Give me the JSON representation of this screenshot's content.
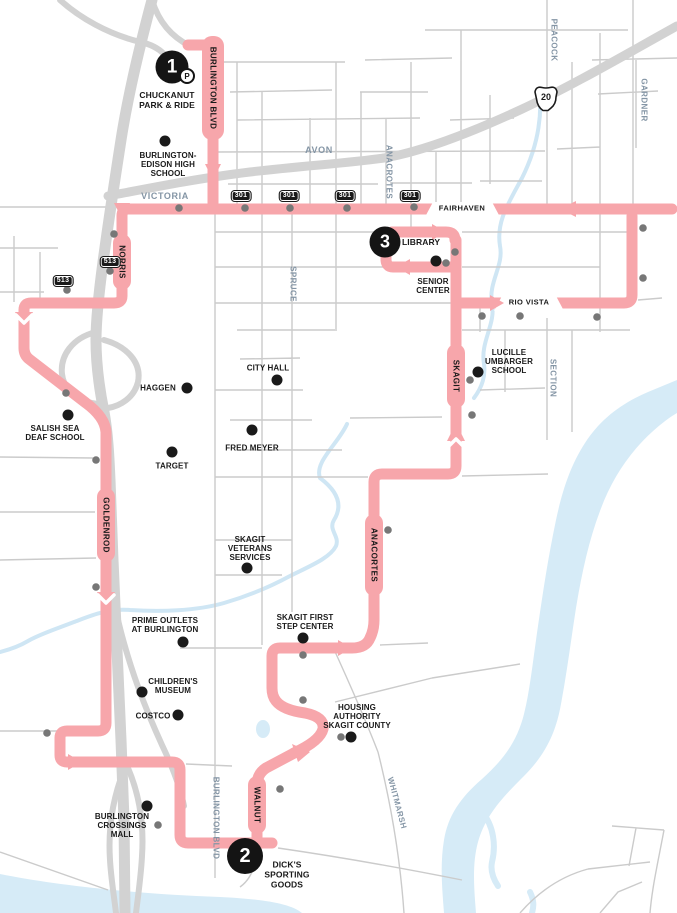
{
  "stops": {
    "s1": {
      "num": "1",
      "name": "CHUCKANUT\nPARK & RIDE",
      "badge": "P"
    },
    "s2": {
      "num": "2",
      "name": "DICK'S\nSPORTING\nGOODS"
    },
    "s3": {
      "num": "3",
      "name": "LIBRARY"
    }
  },
  "streets": {
    "burlington_blvd_top": "BURLINGTON BLVD",
    "burlington_blvd_bottom": "BURLINGTON BLVD",
    "avon": "AVON",
    "victoria": "VICTORIA",
    "fairhaven": "FAIRHAVEN",
    "rio_vista": "RIO VISTA",
    "norris": "NORRIS",
    "spruce": "SPRUCE",
    "anacrotes": "ANACROTES",
    "peacock": "PEACOCK",
    "gardner": "GARDNER",
    "section": "SECTION",
    "skagit": "SKAGIT",
    "goldenrod": "GOLDENROD",
    "anacortes": "ANACORTES",
    "walnut": "WALNUT",
    "whitmarsh": "WHITMARSH"
  },
  "landmarks": {
    "be_high_school": "BURLINGTON-\nEDISON HIGH\nSCHOOL",
    "senior_center": "SENIOR\nCENTER",
    "lucille": "LUCILLE\nUMBARGER\nSCHOOL",
    "city_hall": "CITY HALL",
    "haggen": "HAGGEN",
    "fred_meyer": "FRED MEYER",
    "target": "TARGET",
    "salish": "SALISH SEA\nDEAF SCHOOL",
    "skagit_vets": "SKAGIT\nVETERANS\nSERVICES",
    "prime_outlets": "PRIME OUTLETS\nAT BURLINGTON",
    "childrens_museum": "CHILDREN'S\nMUSEUM",
    "costco": "COSTCO",
    "mall": "BURLINGTON\nCROSSINGS\nMALL",
    "first_step": "SKAGIT FIRST\nSTEP CENTER",
    "housing": "HOUSING\nAUTHORITY\nSKAGIT COUNTY"
  },
  "shields": {
    "sr20": "20",
    "rt301": "301",
    "rt513": "513"
  },
  "colors": {
    "route_pink": "#F7A6AB",
    "water_blue": "#D6EBF7",
    "road_gray": "#CBCBCB",
    "freeway_gray": "#D2D2D2",
    "label_gray": "#8495A5",
    "dot_gray": "#777777",
    "black": "#1A1A1A"
  }
}
